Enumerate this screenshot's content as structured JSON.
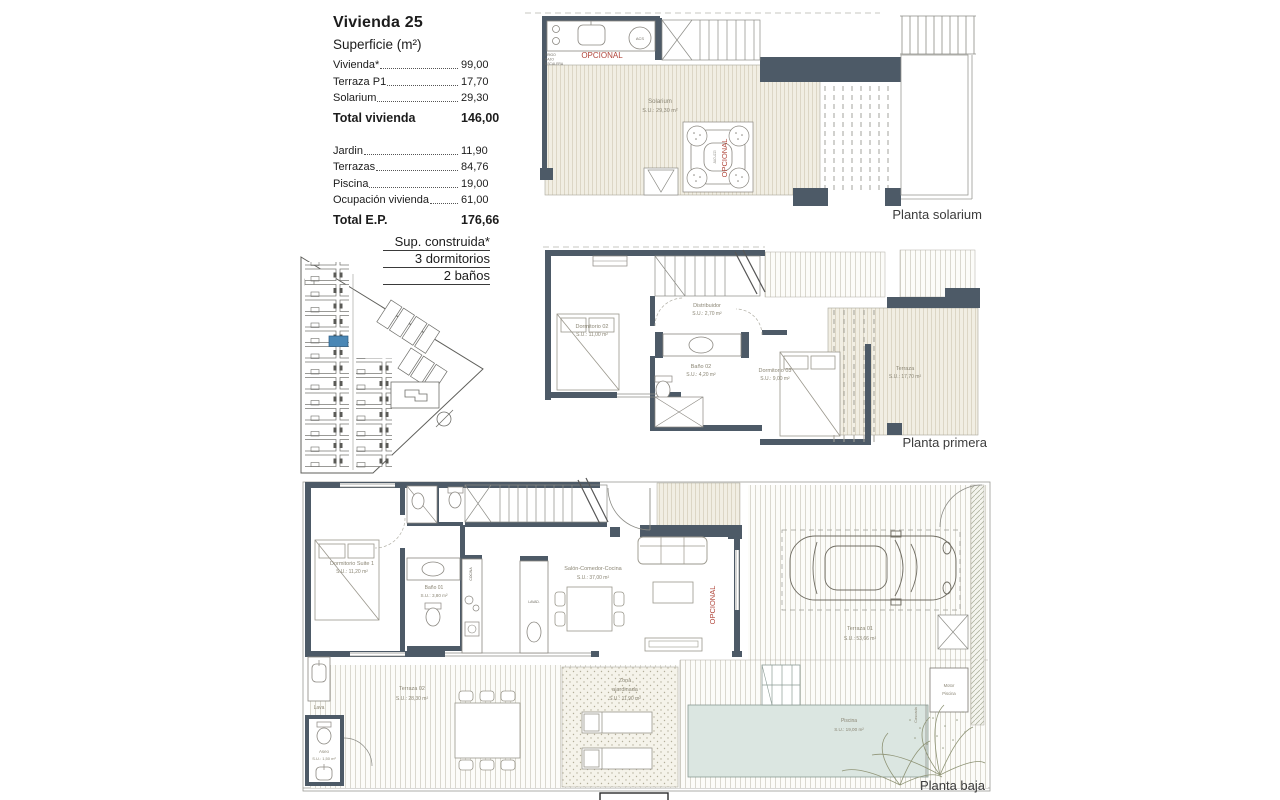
{
  "info": {
    "title": "Vivienda 25",
    "subtitle": "Superficie (m²)",
    "group1": {
      "rows": [
        {
          "label": "Vivienda*",
          "value": "99,00"
        },
        {
          "label": "Terraza P1",
          "value": "17,70"
        },
        {
          "label": "Solarium",
          "value": "29,30"
        }
      ],
      "total": {
        "label": "Total vivienda",
        "value": "146,00"
      }
    },
    "group2": {
      "rows": [
        {
          "label": "Jardin",
          "value": "11,90"
        },
        {
          "label": "Terrazas",
          "value": "84,76"
        },
        {
          "label": "Piscina",
          "value": "19,00"
        },
        {
          "label": "Ocupación vivienda",
          "value": "61,00"
        }
      ],
      "total": {
        "label": "Total E.P.",
        "value": "176,66"
      }
    },
    "spec": [
      "Sup. construida*",
      "3 dormitorios",
      "2 baños"
    ]
  },
  "plans": {
    "solarium": {
      "caption": "Planta solarium",
      "room_name": "Solarium",
      "room_area": "S.U.: 29,30 m²",
      "opcional_kitchen": "OPCIONAL",
      "opcional_jacuzzi": "OPCIONAL",
      "jacuzzi": "JACUZZI",
      "acs": "ACS",
      "frigo": [
        "FRIGO",
        "BAJO",
        "ESCALERA"
      ]
    },
    "primera": {
      "caption": "Planta primera",
      "dorm02_name": "Dormitorio 02",
      "dorm02_area": "S.U.: 11,00 m²",
      "distribuidor_name": "Distribuidor",
      "distribuidor_area": "S.U.: 2,70 m²",
      "bano02_name": "Baño 02",
      "bano02_area": "S.U.: 4,20 m²",
      "dorm03_name": "Dormitorio 03",
      "dorm03_area": "S.U.: 9,00 m²",
      "terraza_name": "Terraza",
      "terraza_area": "S.U.: 17,70 m²"
    },
    "baja": {
      "caption": "Planta baja",
      "suite_name": "Dormitorio Suite 1",
      "suite_area": "S.U.: 11,20 m²",
      "bano01_name": "Baño 01",
      "bano01_area": "S.U.: 3,80 m²",
      "salon_name": "Salón-Comedor-Cocina",
      "salon_area": "S.U.: 37,00 m²",
      "terraza01_name": "Terraza 01",
      "terraza01_area": "S.U.: 53,66 m²",
      "terraza02_name": "Terraza 02",
      "terraza02_area": "S.U.: 28,30 m²",
      "zona_line1": "Zona",
      "zona_line2": "ajardinada",
      "zona_area": "S.U.: 11,90 m²",
      "aseo_name": "Aseo",
      "aseo_area": "S.U.: 1,50 m²",
      "piscina_name": "Piscina",
      "piscina_area": "S.U.: 19,00 m²",
      "lava": "Lava",
      "motor_line1": "Motor",
      "motor_line2": "Piscina",
      "cascada": "Cascada",
      "opcional": "OPCIONAL",
      "cocina": "COCINA",
      "lavad": "LAVAD."
    }
  },
  "colors": {
    "wall": "#4d5a67",
    "deck_line": "#d9d3c1",
    "pool": "#dbe6e1",
    "accent_red": "#b0453a",
    "site_highlight": "#4a87b5"
  }
}
